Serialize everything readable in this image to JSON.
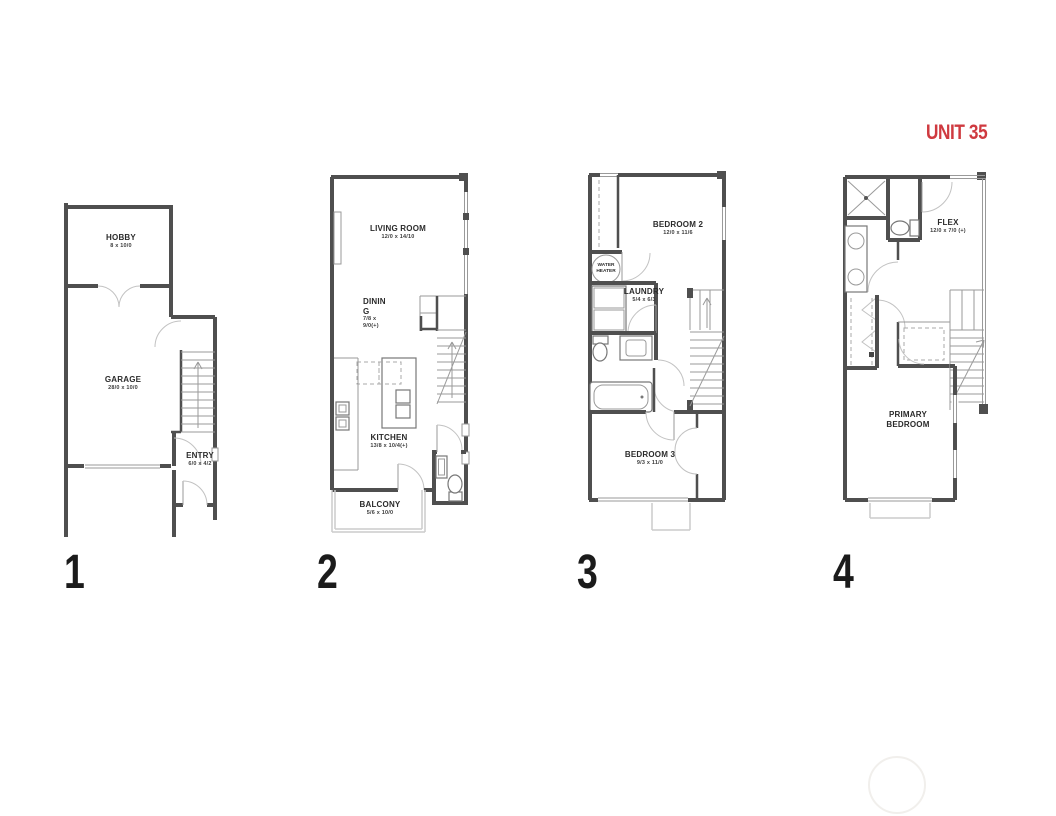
{
  "title": "UNIT 35",
  "title_color": "#cf3a40",
  "wall_color": "#4f4f4f",
  "floors": [
    {
      "number": "1",
      "rooms": [
        {
          "name": "HOBBY",
          "dims": "8 x 10/0"
        },
        {
          "name": "GARAGE",
          "dims": "28/0 x 10/0"
        },
        {
          "name": "ENTRY",
          "dims": "6/0 x 4/2"
        }
      ]
    },
    {
      "number": "2",
      "rooms": [
        {
          "name": "LIVING ROOM",
          "dims": "12/0 x 14/10"
        },
        {
          "name": "DINING",
          "dims": "7/8 x 9/0(+)"
        },
        {
          "name": "KITCHEN",
          "dims": "13/8 x 10/4(+)"
        },
        {
          "name": "BALCONY",
          "dims": "5/6 x 10/0"
        }
      ]
    },
    {
      "number": "3",
      "rooms": [
        {
          "name": "BEDROOM 2",
          "dims": "12/0 x 11/6"
        },
        {
          "name": "WATER HEATER",
          "dims": ""
        },
        {
          "name": "LAUNDRY",
          "dims": "5/4 x 6/3"
        },
        {
          "name": "BEDROOM 3",
          "dims": "9/3 x 11/0"
        }
      ]
    },
    {
      "number": "4",
      "rooms": [
        {
          "name": "FLEX",
          "dims": "12/0 x 7/0 (+)"
        },
        {
          "name": "PRIMARY BEDROOM",
          "dims": "12/3 x 11/5"
        }
      ]
    }
  ]
}
